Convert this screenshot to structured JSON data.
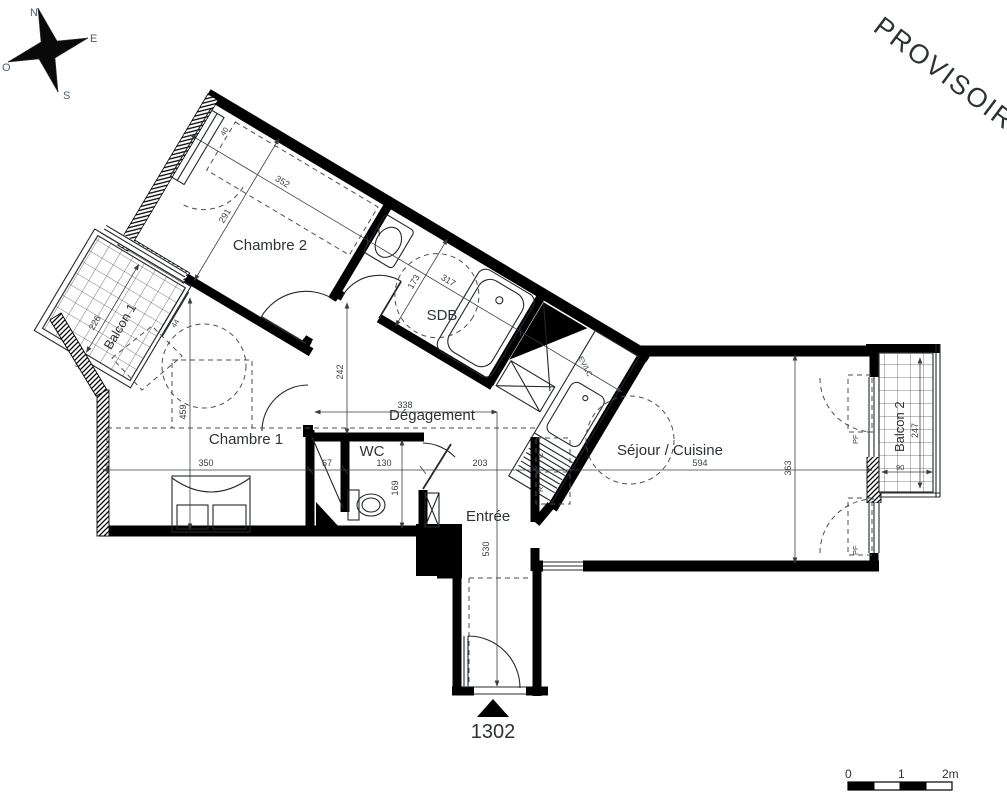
{
  "watermark": {
    "text": "PROVISOIRE",
    "color": "#e8252b"
  },
  "compass": {
    "north": "N",
    "east": "E",
    "south": "S",
    "west": "O"
  },
  "unit": {
    "number": "1302"
  },
  "scale_bar": {
    "tick0": "0",
    "tick1": "1",
    "tick2": "2m"
  },
  "rooms": {
    "chambre2": {
      "name": "Chambre 2",
      "width": "352",
      "depth": "291",
      "window": "40"
    },
    "sdb": {
      "name": "SDB",
      "width": "317",
      "depth": "173"
    },
    "degagement": {
      "name": "Dégagement",
      "width": "338",
      "depth": "242"
    },
    "chambre1": {
      "name": "Chambre 1",
      "width": "350",
      "height": "459",
      "window": "44"
    },
    "wc": {
      "name": "WC",
      "width": "130",
      "depth": "169",
      "closet": "67"
    },
    "entree": {
      "name": "Entrée",
      "width": "203",
      "corridor": "530"
    },
    "sejour": {
      "name": "Séjour / Cuisine",
      "width": "594",
      "depth": "363"
    },
    "balcon1": {
      "name": "Balcon 1",
      "length": "226",
      "width": "92"
    },
    "balcon2": {
      "name": "Balcon 2",
      "length": "247",
      "width": "90"
    }
  },
  "labels": {
    "kitchen_sink": "EV/LC",
    "window_type_top": "PF",
    "window_type_bottom": "PF",
    "cooker": "C",
    "fridge": "R"
  },
  "colors": {
    "walls": "#000000",
    "dims": "#3a3e42"
  }
}
